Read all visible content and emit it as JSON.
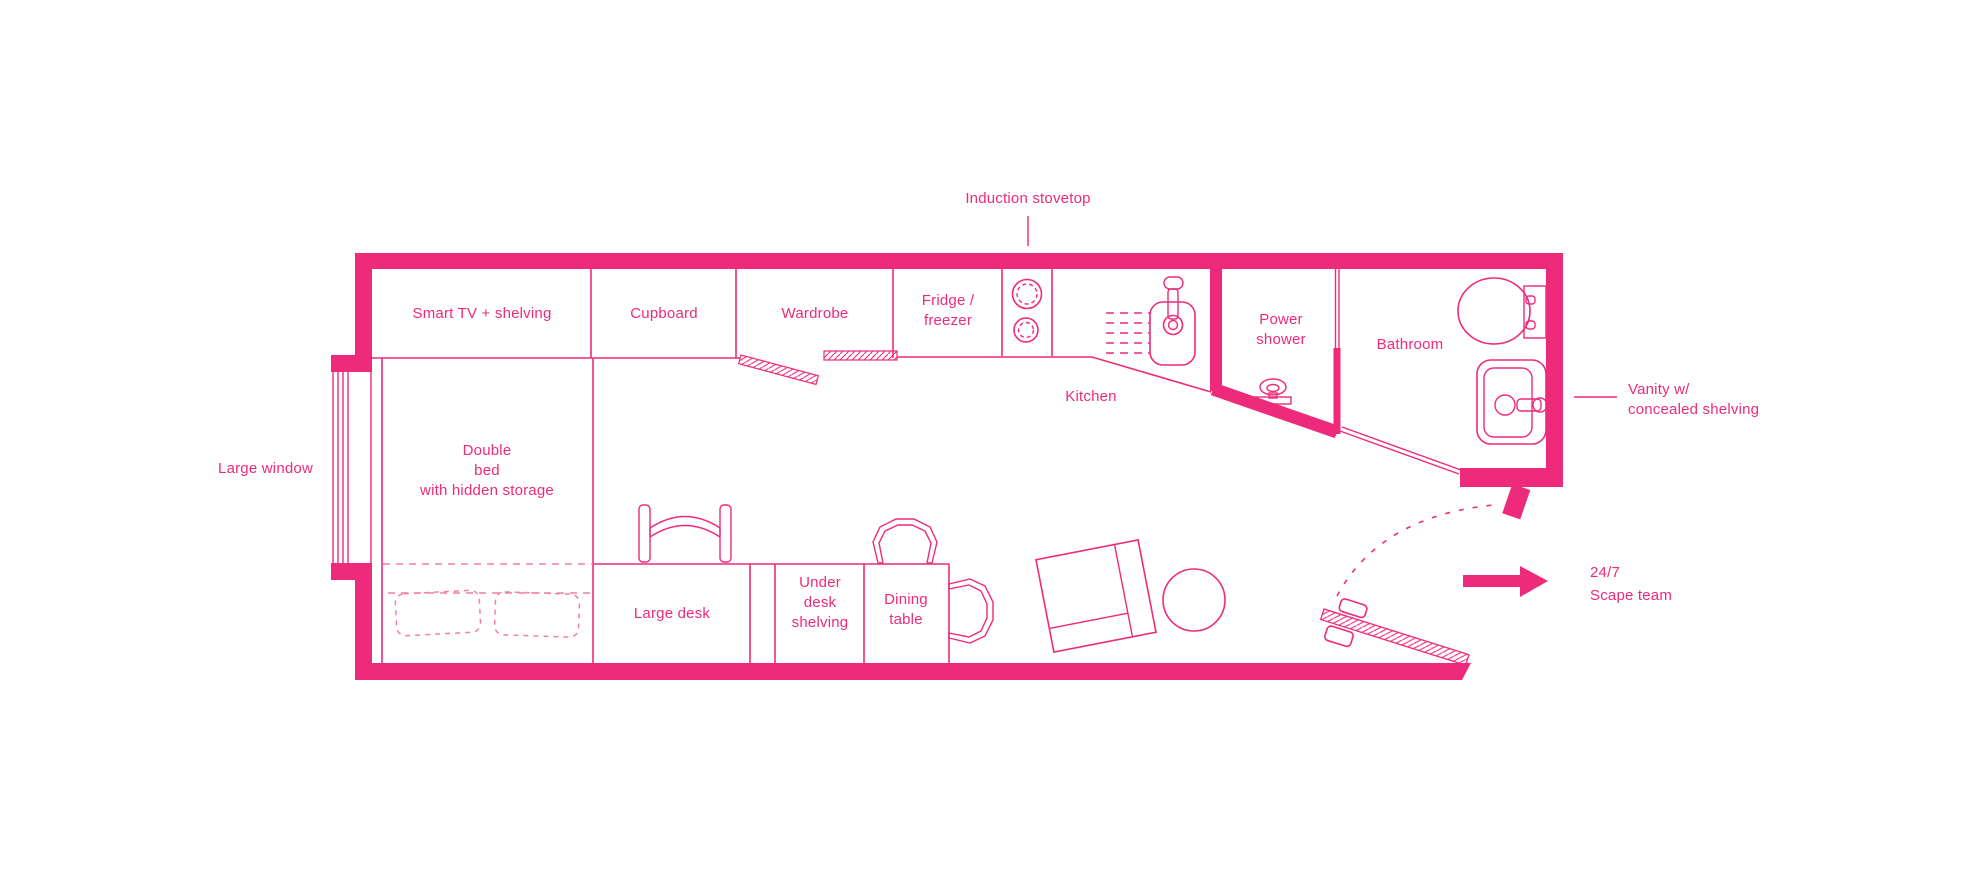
{
  "colors": {
    "pink": "#EE2A7B",
    "pink_light": "#F47FAC",
    "background": "#FFFFFF"
  },
  "callouts": {
    "induction_stovetop": "Induction stovetop",
    "large_window": "Large window",
    "vanity_line1": "Vanity w/",
    "vanity_line2": "concealed shelving",
    "team_line1": "24/7",
    "team_line2": "Scape team"
  },
  "rooms": {
    "kitchen": "Kitchen",
    "bathroom": "Bathroom",
    "power_shower_line1": "Power",
    "power_shower_line2": "shower"
  },
  "furniture": {
    "smart_tv": "Smart TV + shelving",
    "cupboard": "Cupboard",
    "wardrobe": "Wardrobe",
    "fridge_line1": "Fridge /",
    "fridge_line2": "freezer",
    "bed_line1": "Double",
    "bed_line2": "bed",
    "bed_line3": "with hidden storage",
    "large_desk": "Large desk",
    "under_desk_line1": "Under",
    "under_desk_line2": "desk",
    "under_desk_line3": "shelving",
    "dining_line1": "Dining",
    "dining_line2": "table"
  },
  "icons": {
    "stovetop": "two-burner-circles",
    "kitchen_sink": "sink-with-faucet",
    "drainer": "dashed-drainer-grooves",
    "shower": "shower-head",
    "toilet": "toilet-top-view",
    "vanity_basin": "basin-with-tap",
    "entry_arrow": "right-arrow",
    "entry_door": "open-door-leaf",
    "door_swing": "dashed-arc"
  }
}
